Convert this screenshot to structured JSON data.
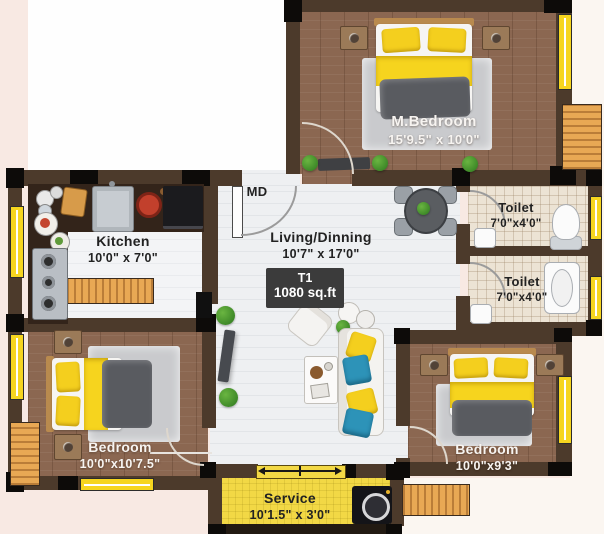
{
  "unit": {
    "code": "T1",
    "area": "1080 sq.ft"
  },
  "door_label": "MD",
  "rooms": {
    "master_bedroom": {
      "name": "M.Bedroom",
      "dims": "15'9.5\" x 10'0\""
    },
    "toilet_top": {
      "name": "Toilet",
      "dims": "7'0\"x4'0\""
    },
    "toilet_bottom": {
      "name": "Toilet",
      "dims": "7'0\"x4'0\""
    },
    "kitchen": {
      "name": "Kitchen",
      "dims": "10'0\" x 7'0\""
    },
    "living": {
      "name": "Living/Dinning",
      "dims": "10'7\" x 17'0\""
    },
    "bedroom_left": {
      "name": "Bedroom",
      "dims": "10'0\"x10'7.5\""
    },
    "bedroom_right": {
      "name": "Bedroom",
      "dims": "10'0\"x9'3\""
    },
    "service": {
      "name": "Service",
      "dims": "10'1.5\" x 3'0\""
    }
  },
  "colors": {
    "wall": "#4c3a2b",
    "column": "#0d0b09",
    "window_yellow": "#f6d51f",
    "wood_floor": "#8b6751",
    "living_floor": "#eef0f2",
    "toilet_tile": "#ece3d4",
    "service_yellow": "#f2d845",
    "deck_wood": "#e8a854",
    "bed_yellow": "#f6d41e",
    "duvet_gray": "#595b60",
    "badge_bg": "#3b3b3b"
  }
}
